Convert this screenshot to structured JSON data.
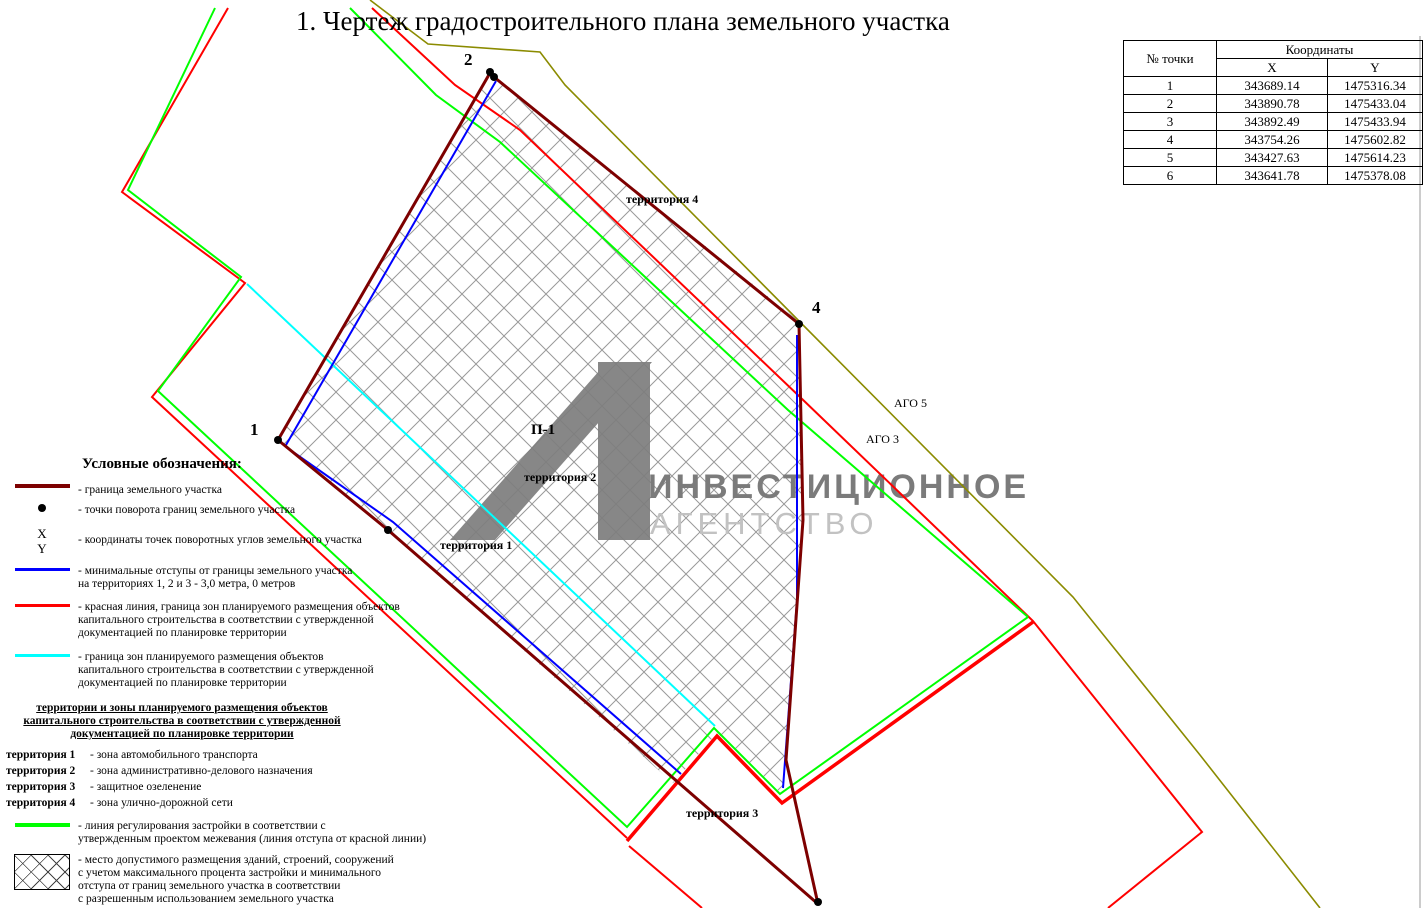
{
  "title": "1. Чертеж градостроительного плана земельного участка",
  "colors": {
    "parcel_boundary": "#7d0000",
    "offset_line": "#0000ff",
    "red_line": "#ff0000",
    "zone_border": "#00ffff",
    "regulation_line": "#00ff00",
    "ago_line": "#8b8b00",
    "hatch_line": "#999999",
    "watermark_dark": "#7b7b7b",
    "watermark_light": "#c2c2c2"
  },
  "coords_table": {
    "header_group": "Координаты",
    "col_point": "№ точки",
    "col_x": "X",
    "col_y": "Y",
    "rows": [
      {
        "point": "1",
        "x": "343689.14",
        "y": "1475316.34"
      },
      {
        "point": "2",
        "x": "343890.78",
        "y": "1475433.04"
      },
      {
        "point": "3",
        "x": "343892.49",
        "y": "1475433.94"
      },
      {
        "point": "4",
        "x": "343754.26",
        "y": "1475602.82"
      },
      {
        "point": "5",
        "x": "343427.63",
        "y": "1475614.23"
      },
      {
        "point": "6",
        "x": "343641.78",
        "y": "1475378.08"
      }
    ]
  },
  "legend": {
    "heading": "Условные обозначения:",
    "boundary": "-  граница земельного участка",
    "turn_points": "-  точки поворота границ земельного участка",
    "xy_x": "X",
    "xy_y": "Y",
    "xy_text": "-  координаты точек поворотных углов земельного участка",
    "offsets": "-  минимальные отступы от границы земельного участка\nна территориях 1, 2 и 3 - 3,0 метра, 0 метров",
    "red_line": "-  красная линия, граница зон планируемого размещения объектов\nкапитального строительства в соответствии с утвержденной\nдокументацией по планировке территории",
    "zone_border": "-  граница зон планируемого размещения объектов\nкапитального строительства в соответствии с утвержденной\nдокументацией по планировке территории",
    "territories_heading": "территории и зоны планируемого размещения объектов\nкапитального строительства в соответствии с утвержденной\nдокументацией по планировке территории",
    "territory1_label": "территория 1",
    "territory1_text": "-  зона автомобильного транспорта",
    "territory2_label": "территория 2",
    "territory2_text": "-  зона административно-делового назначения",
    "territory3_label": "территория 3",
    "territ3_unused": "",
    "territory3_text": "-  защитное озеленение",
    "territory4_label": "территория 4",
    "territory4_text": "-  зона улично-дорожной сети",
    "regulation": "- линия регулирования застройки в соответствии с\nутвержденным проектом межевания (линия отступа от красной линии)",
    "placement": "-  место допустимого размещения зданий, строений, сооружений\nс учетом максимального процента застройки и минимального\nотступа от границ земельного участка в соответствии\nс разрешенным использованием земельного участка",
    "zone_name": "П-1",
    "zone_name_text": "-  наименование территориальной зоны застройки"
  },
  "map": {
    "point1": "1",
    "point2": "2",
    "point4": "4",
    "zone": "П-1",
    "territory1": "территория 1",
    "territory2": "территория 2",
    "territory3": "территория 3",
    "territory4": "территория 4",
    "ago3": "АГО 3",
    "ago5": "АГО 5"
  },
  "watermark": {
    "line1": "ИНВЕСТИЦИОННОЕ",
    "line2": "АГЕНТСТВО"
  }
}
